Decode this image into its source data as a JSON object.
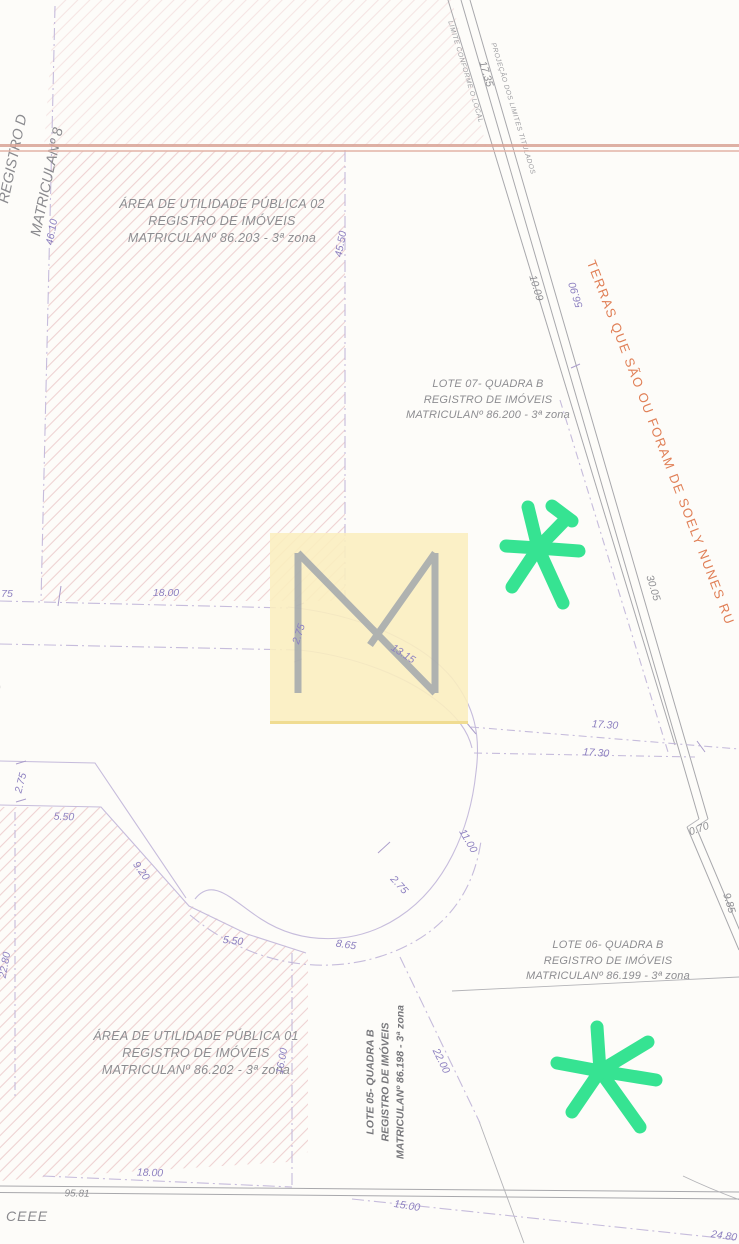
{
  "map": {
    "region_labels": {
      "area02": [
        "ÁREA DE UTILIDADE PÚBLICA 02",
        "REGISTRO DE IMÓVEIS",
        "MATRICULANº 86.203 - 3ª zona"
      ],
      "lote07": [
        "LOTE 07- QUADRA B",
        "REGISTRO DE IMÓVEIS",
        "MATRICULANº 86.200 - 3ª zona"
      ],
      "lote06": [
        "LOTE 06- QUADRA B",
        "REGISTRO DE IMÓVEIS",
        "MATRICULANº 86.199 - 3ª zona"
      ],
      "area01": [
        "ÁREA DE UTILIDADE PÚBLICA 01",
        "REGISTRO DE IMÓVEIS",
        "MATRICULANº 86.202 - 3ª zona"
      ],
      "lote05": [
        "LOTE 05- QUADRA B",
        "REGISTRO DE IMÓVEIS",
        "MATRICULANº 86.198 - 3ª zona"
      ]
    },
    "boundary_labels": {
      "limite_local": "LIMITE CONFORME O LOCAL",
      "projecao_titulados": "PROJEÇÃO DOS LIMITES TITULADOS",
      "terras": "TERRAS QUE SÃO OU FORAM DE SOELY NUNES RU",
      "edge_clipped_line1": "REGISTRO D",
      "edge_clipped_line2": "MATRICULANº 8",
      "ceee": "CEEE",
      "edge_paren": ")"
    },
    "measurements": [
      {
        "text": "17.35",
        "x": 486,
        "y": 74,
        "rot": 73,
        "c": "gray"
      },
      {
        "text": "10.09",
        "x": 536,
        "y": 288,
        "rot": 73,
        "c": "gray"
      },
      {
        "text": "56.90",
        "x": 576,
        "y": 295,
        "rot": 253,
        "c": "purple"
      },
      {
        "text": "30.05",
        "x": 653,
        "y": 588,
        "rot": 73,
        "c": "gray"
      },
      {
        "text": "0.70",
        "x": 699,
        "y": 829,
        "rot": -20,
        "c": "gray"
      },
      {
        "text": "9.85",
        "x": 729,
        "y": 903,
        "rot": 73,
        "c": "gray"
      },
      {
        "text": "46.10",
        "x": 52,
        "y": 232,
        "rot": -80,
        "c": "purple"
      },
      {
        "text": "45.50",
        "x": 341,
        "y": 244,
        "rot": -80,
        "c": "purple"
      },
      {
        "text": "75",
        "x": 7,
        "y": 594,
        "rot": 0,
        "c": "purple"
      },
      {
        "text": "18.00",
        "x": 166,
        "y": 593,
        "rot": 0,
        "c": "purple"
      },
      {
        "text": "2.75",
        "x": 299,
        "y": 634,
        "rot": -72,
        "c": "purple"
      },
      {
        "text": "13.15",
        "x": 403,
        "y": 654,
        "rot": 33,
        "c": "purple"
      },
      {
        "text": "17.30",
        "x": 605,
        "y": 725,
        "rot": 4,
        "c": "purple"
      },
      {
        "text": "17.30",
        "x": 596,
        "y": 753,
        "rot": 4,
        "c": "purple"
      },
      {
        "text": "2.75",
        "x": 21,
        "y": 783,
        "rot": -75,
        "c": "purple"
      },
      {
        "text": "5.50",
        "x": 64,
        "y": 817,
        "rot": 2,
        "c": "purple"
      },
      {
        "text": "9.20",
        "x": 141,
        "y": 871,
        "rot": 54,
        "c": "purple"
      },
      {
        "text": "11.00",
        "x": 468,
        "y": 841,
        "rot": 60,
        "c": "purple"
      },
      {
        "text": "2.75",
        "x": 399,
        "y": 885,
        "rot": 48,
        "c": "purple"
      },
      {
        "text": "5.50",
        "x": 233,
        "y": 941,
        "rot": 6,
        "c": "purple"
      },
      {
        "text": "8.65",
        "x": 346,
        "y": 945,
        "rot": 8,
        "c": "purple"
      },
      {
        "text": "22.80",
        "x": 5,
        "y": 965,
        "rot": -80,
        "c": "purple"
      },
      {
        "text": "16.00",
        "x": 282,
        "y": 1061,
        "rot": -80,
        "c": "purple"
      },
      {
        "text": "22.00",
        "x": 441,
        "y": 1061,
        "rot": 64,
        "c": "purple"
      },
      {
        "text": "18.00",
        "x": 150,
        "y": 1173,
        "rot": 2,
        "c": "purple"
      },
      {
        "text": "95.81",
        "x": 77,
        "y": 1194,
        "rot": 1,
        "c": "gray",
        "size": 10
      },
      {
        "text": "15.00",
        "x": 407,
        "y": 1206,
        "rot": 9,
        "c": "purple"
      },
      {
        "text": "24.80",
        "x": 724,
        "y": 1236,
        "rot": 8,
        "c": "purple"
      }
    ],
    "icons": {
      "watermark": "m-monogram-icon",
      "annotation": "green-asterisk-icon"
    },
    "colors": {
      "dimension_purple": "#8d80c0",
      "label_gray": "#8e8e92",
      "boundary_orange": "#e07f56",
      "annotation_green": "#36e392",
      "watermark_yellow": "#faeebe",
      "hatch_pink": "#eed2d2",
      "fold_pink": "#d8a295"
    }
  }
}
